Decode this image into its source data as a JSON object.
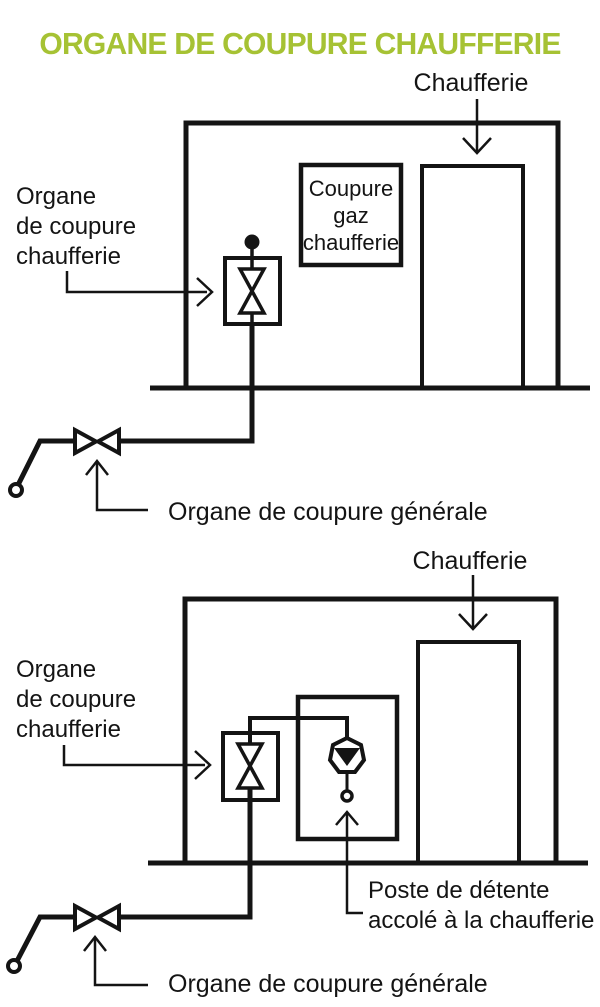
{
  "title": "ORGANE DE COUPURE CHAUFFERIE",
  "colors": {
    "title_green": "#a6c234",
    "ink": "#141414"
  },
  "diagram_top": {
    "chaufferie_label": "Chaufferie",
    "organe_chaufferie_lines": [
      "Organe",
      "de coupure",
      "chaufferie"
    ],
    "coupure_gaz_lines": [
      "Coupure",
      "gaz",
      "chaufferie"
    ],
    "generale_label": "Organe de coupure générale"
  },
  "diagram_bottom": {
    "chaufferie_label": "Chaufferie",
    "organe_chaufferie_lines": [
      "Organe",
      "de coupure",
      "chaufferie"
    ],
    "poste_detente_lines": [
      "Poste de détente",
      "accolé à la chaufferie"
    ],
    "generale_label": "Organe de coupure générale"
  }
}
